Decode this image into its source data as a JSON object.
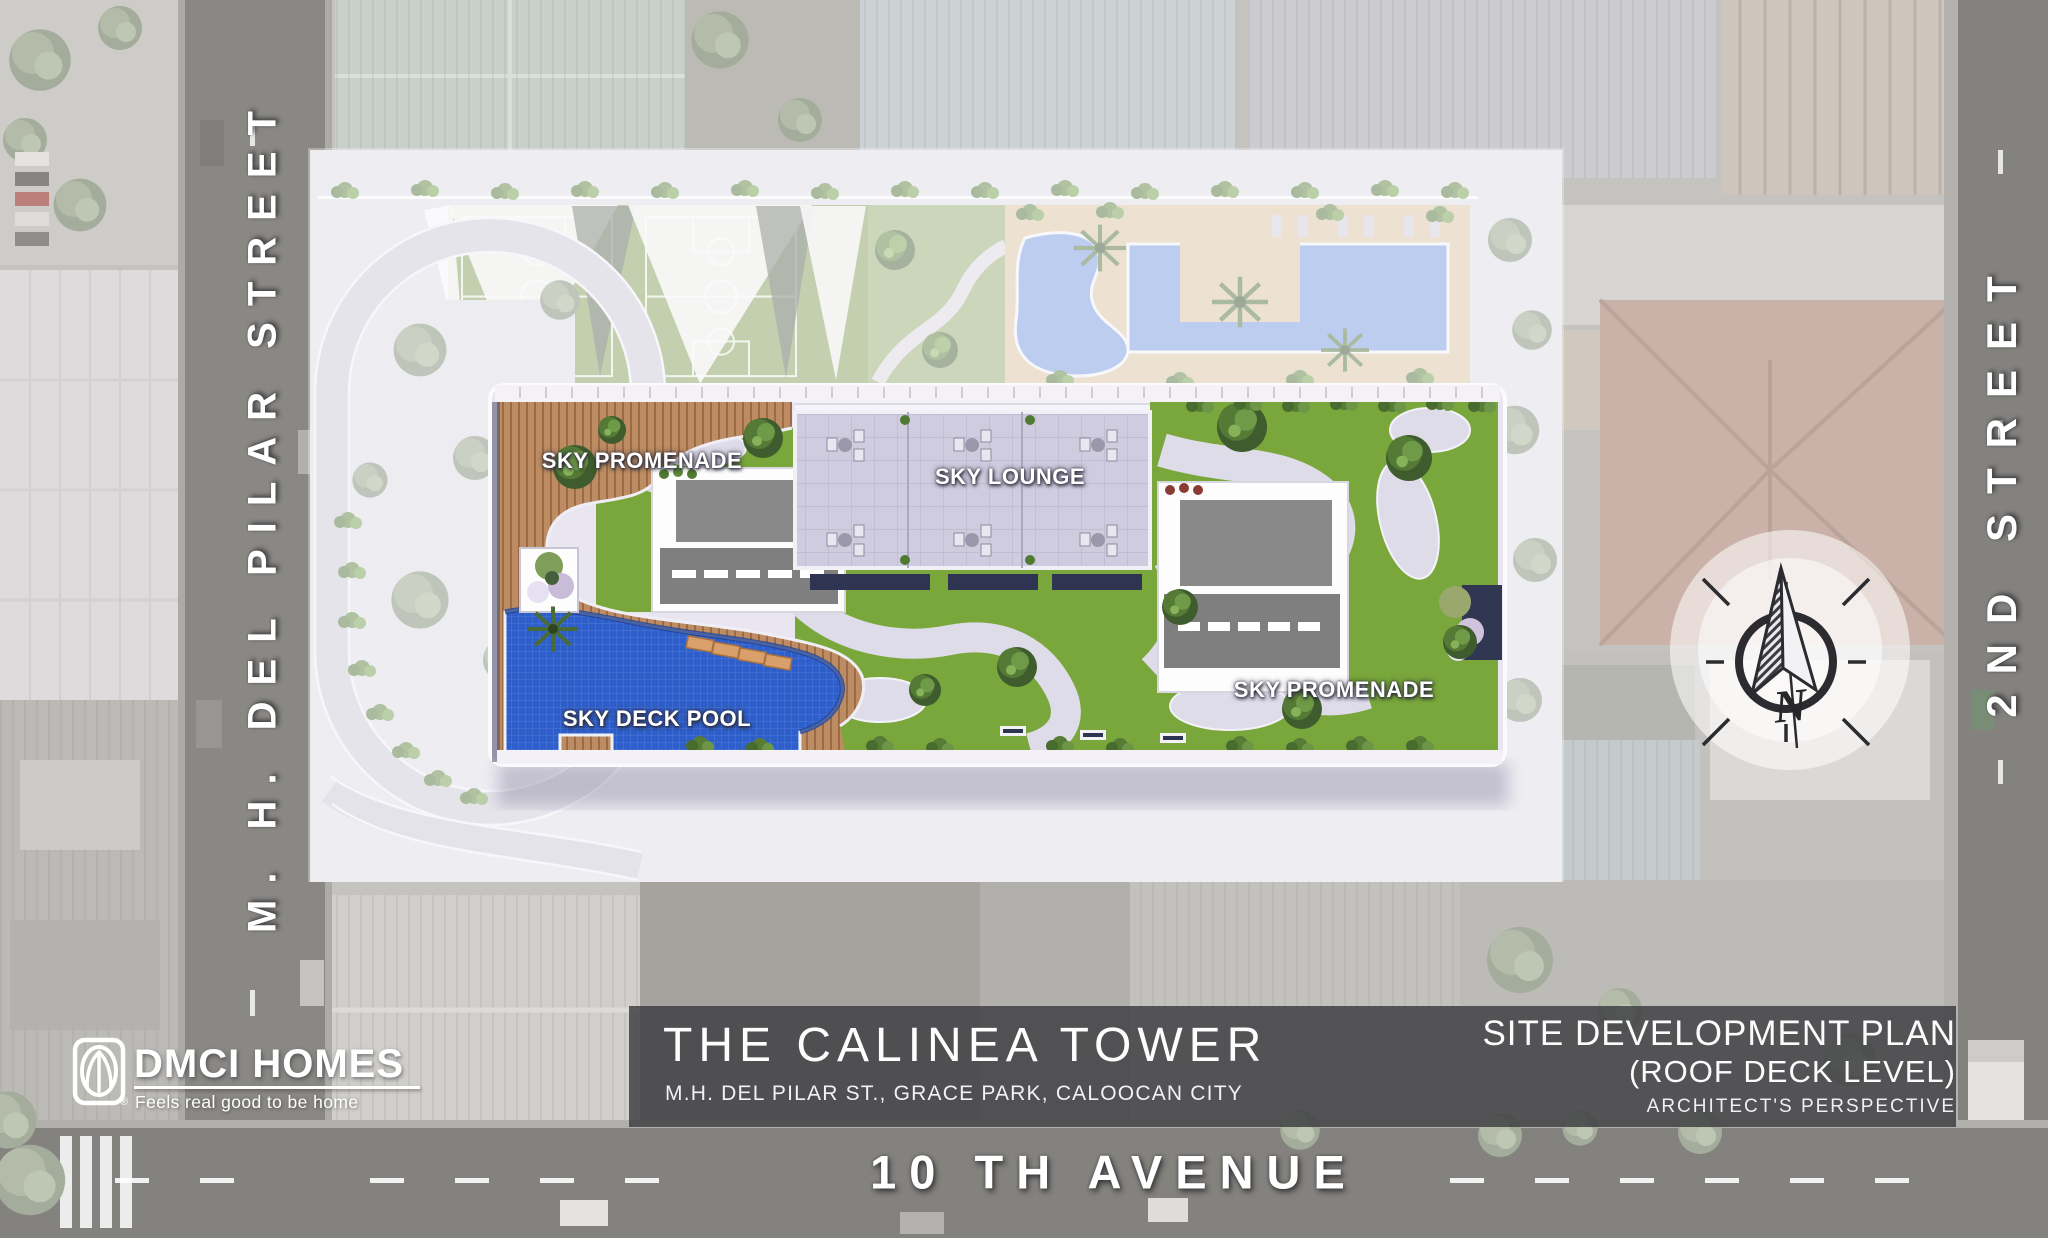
{
  "streets": {
    "left_vertical": "M. H. DEL PILAR STREET",
    "right_vertical": "2ND STREET",
    "bottom": "10 TH AVENUE"
  },
  "deck_labels": {
    "sky_promenade_left": "SKY PROMENADE",
    "sky_lounge": "SKY LOUNGE",
    "sky_deck_pool": "SKY DECK POOL",
    "sky_promenade_right": "SKY PROMENADE"
  },
  "title_bar": {
    "project_name": "THE CALINEA TOWER",
    "project_address": "M.H. DEL PILAR ST., GRACE PARK, CALOOCAN CITY",
    "plan_title": "SITE DEVELOPMENT PLAN",
    "plan_level": "(ROOF DECK LEVEL)",
    "plan_view_note": "ARCHITECT'S PERSPECTIVE"
  },
  "brand": {
    "name": "DMCI HOMES",
    "tagline": "Feels real good to be home",
    "registered_mark": "®"
  },
  "compass": {
    "north_label": "N"
  },
  "colors": {
    "sky_deck_pool_blue": "#2e5ec9",
    "amenity_pool_blue": "#6f93dc",
    "lawn_green": "#79a73b",
    "wood_deck_tan": "#bd8c63",
    "deck_paving": "#e9e6f1",
    "title_bar_overlay": "#3e3e42",
    "label_text": "#ffffff",
    "navy_planter": "#313653",
    "terracotta_roof": "#b08a7c"
  }
}
